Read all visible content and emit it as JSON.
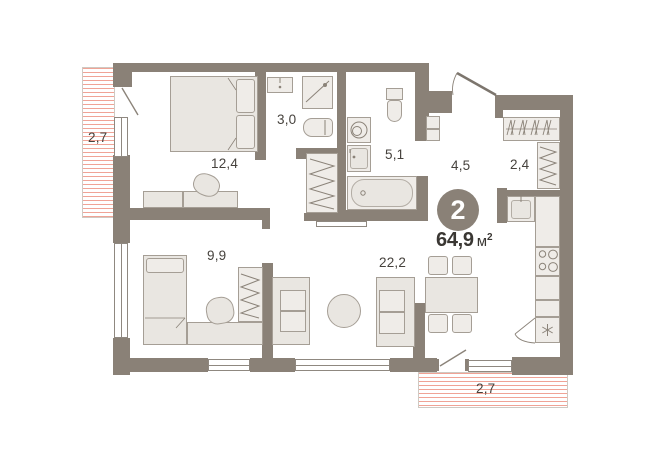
{
  "plan": {
    "title": "apartment-floor-plan",
    "summary": {
      "rooms_badge": "2",
      "total_area": "64,9",
      "area_unit_base": "м",
      "area_unit_sup": "2",
      "total_area_display": "64,9 м²"
    },
    "rooms": [
      {
        "id": "bedroom",
        "area": "12,4"
      },
      {
        "id": "wc",
        "area": "3,0"
      },
      {
        "id": "bathroom",
        "area": "5,1"
      },
      {
        "id": "hallway",
        "area": "4,5"
      },
      {
        "id": "wardrobe",
        "area": "2,4"
      },
      {
        "id": "room-second",
        "area": "9,9"
      },
      {
        "id": "living-kitchen",
        "area": "22,2"
      },
      {
        "id": "balcony-left",
        "area": "2,7"
      },
      {
        "id": "balcony-bottom",
        "area": "2,7"
      }
    ],
    "fixtures": [
      "double-bed",
      "dresser",
      "bedroom-chair",
      "wc-sink",
      "shower-cabin",
      "wc-toilet",
      "washing-machine",
      "bathroom-sink",
      "bathtub",
      "bathroom-toilet",
      "linen-shelving",
      "hanger-rod",
      "wardrobe-shelves",
      "kitchen-sink",
      "kitchen-counter",
      "stove",
      "fridge",
      "single-bed",
      "desk",
      "desk-chair",
      "clothes-rail",
      "sofa-left",
      "sofa-right",
      "coffee-table",
      "dining-table",
      "dining-chairs",
      "entrance-door",
      "balcony-door-left",
      "balcony-door-bottom"
    ],
    "colors": {
      "wall": "#8a8177",
      "furniture_fill": "#e9e6e1",
      "furniture_stroke": "#a59e95",
      "balcony_hatch": "#f0a396",
      "label_text": "#46423d",
      "badge_bg": "#8a8177",
      "badge_text": "#ffffff"
    }
  }
}
